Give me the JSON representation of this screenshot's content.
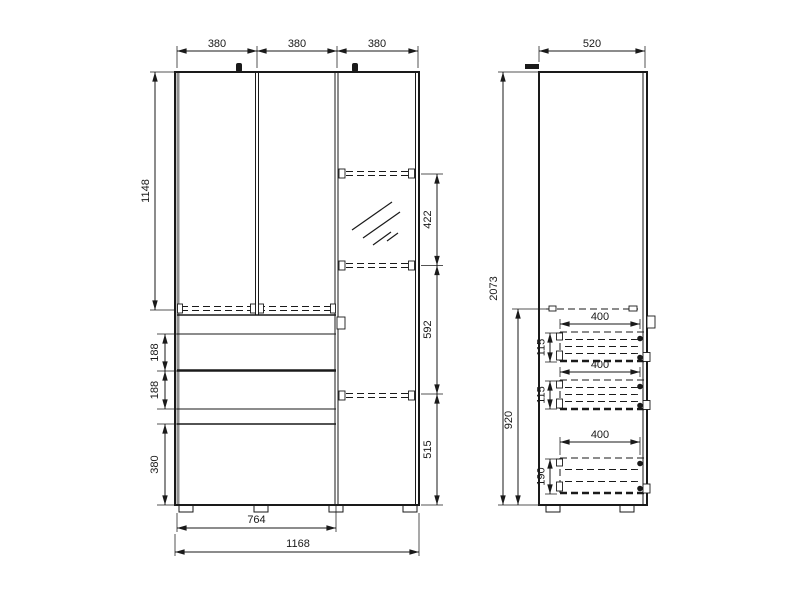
{
  "front_view": {
    "door_widths": [
      "380",
      "380",
      "380"
    ],
    "upper_height": "1148",
    "drawer_heights": [
      "188",
      "188"
    ],
    "bottom_drawer_height": "380",
    "right_gaps": [
      "422",
      "592",
      "515"
    ],
    "drawer_unit_width": "764",
    "total_width": "1168"
  },
  "side_view": {
    "depth": "520",
    "total_height": "2073",
    "lower_unit_height": "920",
    "drawers": [
      {
        "depth": "400",
        "front_height": "115"
      },
      {
        "depth": "400",
        "front_height": "115"
      },
      {
        "depth": "400",
        "front_height": "190"
      }
    ]
  },
  "colors": {
    "line": "#1a1a1a",
    "background": "#ffffff",
    "panel_edge": "#8f8f8f"
  }
}
